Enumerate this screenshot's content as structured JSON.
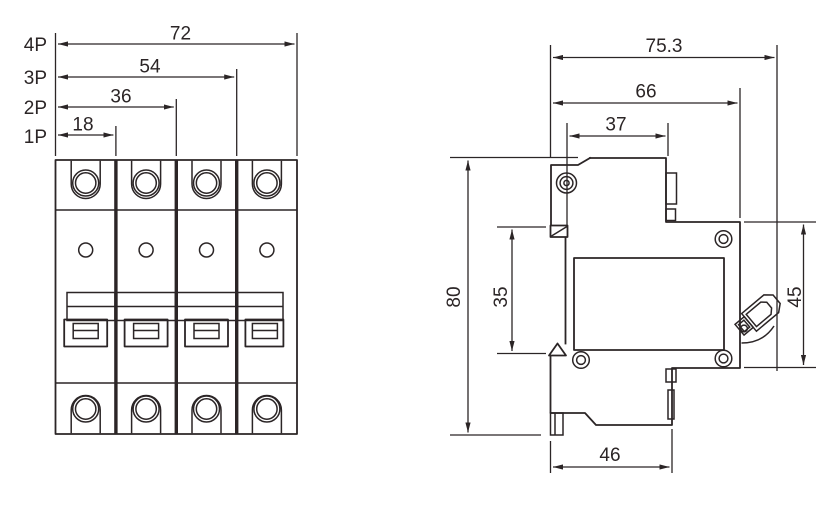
{
  "drawing": {
    "type": "technical-dimension-drawing",
    "subject": "miniature circuit breaker (MCB) outline dimensions",
    "colors": {
      "line": "#2b2526",
      "background": "#ffffff"
    },
    "front_view": {
      "poles": 4,
      "rows": [
        {
          "label": "4P",
          "dim": "72"
        },
        {
          "label": "3P",
          "dim": "54"
        },
        {
          "label": "2P",
          "dim": "36"
        },
        {
          "label": "1P",
          "dim": "18"
        }
      ]
    },
    "side_view": {
      "overall_width": "75.3",
      "body_width": "66",
      "top_width": "37",
      "overall_height": "80",
      "din_height": "35",
      "right_height": "45",
      "base_width": "46"
    }
  }
}
